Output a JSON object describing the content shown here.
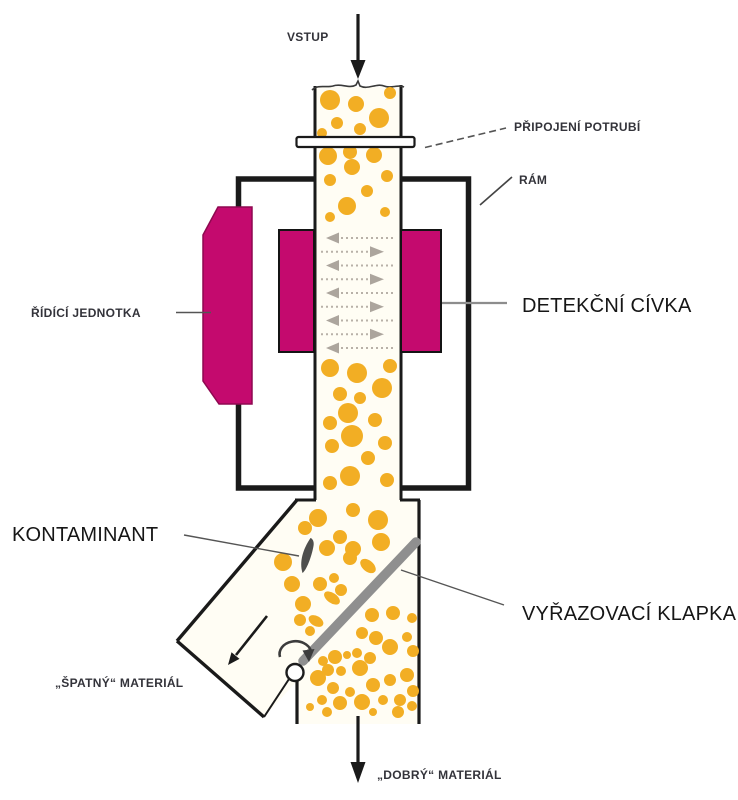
{
  "labels": {
    "vstup": "VSTUP",
    "pripojeni_potrubi": "PŘIPOJENÍ POTRUBÍ",
    "ram": "RÁM",
    "ridici_jednotka": "ŘÍDÍCÍ JEDNOTKA",
    "detekcni_civka": "DETEKČNÍ CÍVKA",
    "kontaminant": "KONTAMINANT",
    "vyrazovaci_klapka": "VYŘAZOVACÍ KLAPKA",
    "spatny_material": "„ŠPATNÝ“ MATERIÁL",
    "dobry_material": "„DOBRÝ“ MATERIÁL"
  },
  "colors": {
    "magenta": "#C40A6E",
    "magenta_edge": "#8E0850",
    "orange": "#F2AE24",
    "flap_gray": "#8F8F8F",
    "contaminant": "#4E4E4C",
    "field_arrow": "#ACA59D",
    "field_dots": "#B8B1A8",
    "ink": "#1A1A1A",
    "pipe_fill": "#FFFDF4"
  },
  "coil_arrows": {
    "count": 9,
    "y_start": 238,
    "y_step": 13.75,
    "half_height": 5.5,
    "left_tip_x": 326,
    "left_head_back_x": 339,
    "left_tail_x": 394,
    "right_tail_x": 321,
    "right_head_back_x": 370,
    "right_tip_x": 384
  },
  "dots": [
    [
      330,
      100,
      10
    ],
    [
      356,
      104,
      8
    ],
    [
      390,
      93,
      6
    ],
    [
      337,
      123,
      6
    ],
    [
      379,
      118,
      10
    ],
    [
      360,
      129,
      6
    ],
    [
      322,
      133,
      5
    ],
    [
      328,
      156,
      9
    ],
    [
      350,
      152,
      7
    ],
    [
      374,
      155,
      8
    ],
    [
      352,
      167,
      8
    ],
    [
      330,
      180,
      6
    ],
    [
      387,
      176,
      6
    ],
    [
      367,
      191,
      6
    ],
    [
      347,
      206,
      9
    ],
    [
      385,
      212,
      5
    ],
    [
      330,
      217,
      5
    ],
    [
      330,
      368,
      9
    ],
    [
      357,
      373,
      10
    ],
    [
      390,
      366,
      7
    ],
    [
      340,
      394,
      7
    ],
    [
      382,
      388,
      10
    ],
    [
      360,
      398,
      6
    ],
    [
      348,
      413,
      10
    ],
    [
      330,
      423,
      7
    ],
    [
      375,
      420,
      7
    ],
    [
      352,
      436,
      11
    ],
    [
      385,
      443,
      7
    ],
    [
      332,
      446,
      7
    ],
    [
      368,
      458,
      7
    ],
    [
      350,
      476,
      10
    ],
    [
      330,
      483,
      7
    ],
    [
      387,
      480,
      7
    ],
    [
      318,
      518,
      9
    ],
    [
      353,
      510,
      7
    ],
    [
      378,
      520,
      10
    ],
    [
      340,
      537,
      7
    ],
    [
      327,
      548,
      8
    ],
    [
      305,
      528,
      7
    ],
    [
      353,
      549,
      8
    ],
    [
      381,
      542,
      9
    ],
    [
      350,
      558,
      7
    ],
    [
      320,
      584,
      7
    ],
    [
      334,
      578,
      5
    ],
    [
      341,
      590,
      6
    ],
    [
      303,
      604,
      8
    ],
    [
      283,
      562,
      9
    ],
    [
      292,
      584,
      8
    ],
    [
      300,
      620,
      6
    ],
    [
      310,
      631,
      5
    ],
    [
      372,
      615,
      7
    ],
    [
      393,
      613,
      7
    ],
    [
      412,
      618,
      5
    ],
    [
      362,
      633,
      6
    ],
    [
      376,
      638,
      7
    ],
    [
      390,
      647,
      8
    ],
    [
      407,
      637,
      5
    ],
    [
      413,
      651,
      6
    ],
    [
      357,
      653,
      5
    ],
    [
      370,
      658,
      6
    ],
    [
      335,
      657,
      7
    ],
    [
      323,
      661,
      5
    ],
    [
      347,
      655,
      4
    ],
    [
      328,
      670,
      6
    ],
    [
      341,
      671,
      5
    ],
    [
      360,
      668,
      8
    ],
    [
      318,
      678,
      8
    ],
    [
      333,
      688,
      6
    ],
    [
      350,
      692,
      5
    ],
    [
      373,
      685,
      7
    ],
    [
      390,
      680,
      6
    ],
    [
      407,
      675,
      7
    ],
    [
      413,
      691,
      6
    ],
    [
      322,
      700,
      5
    ],
    [
      340,
      703,
      7
    ],
    [
      362,
      702,
      8
    ],
    [
      383,
      700,
      5
    ],
    [
      400,
      700,
      6
    ],
    [
      310,
      707,
      4
    ],
    [
      327,
      712,
      5
    ],
    [
      373,
      712,
      4
    ],
    [
      398,
      712,
      6
    ],
    [
      412,
      706,
      5
    ]
  ],
  "drops": [
    [
      368,
      566,
      9,
      5.5,
      40
    ],
    [
      332,
      598,
      9,
      5,
      35
    ],
    [
      316,
      621,
      8,
      5,
      30
    ]
  ]
}
